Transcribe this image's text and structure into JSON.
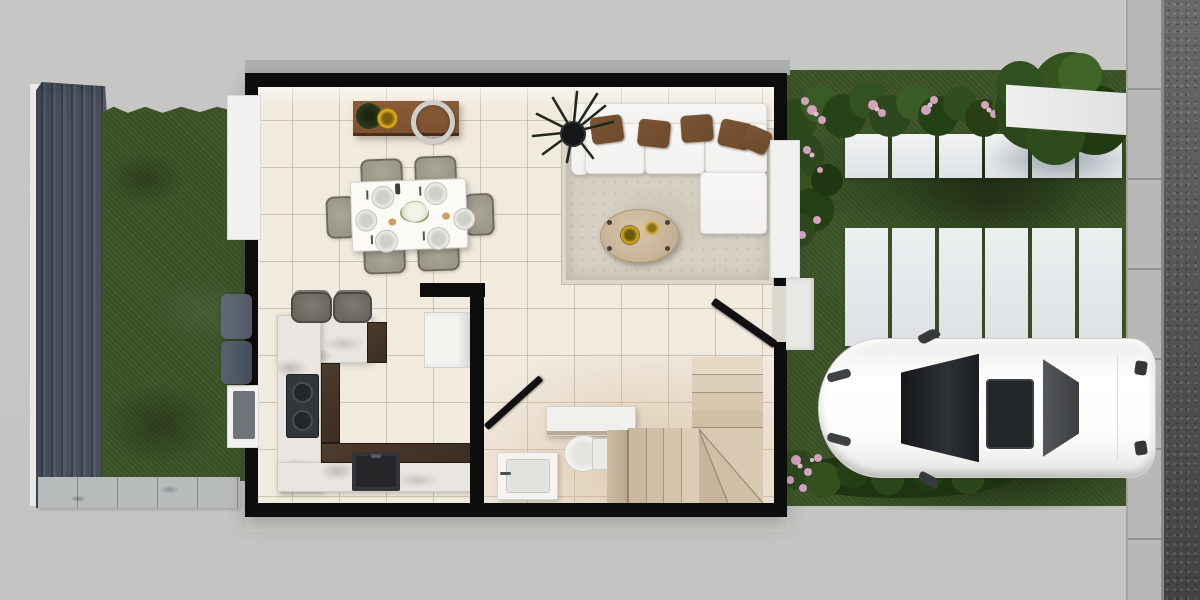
{
  "scene": {
    "render_type": "top-down 3d floor plan render",
    "storeys_visible": 1,
    "rooms": [
      "dining-area",
      "living-area",
      "kitchen",
      "bathroom",
      "stair-hall",
      "entry"
    ],
    "exterior_features": [
      "side-wood-deck",
      "side-lawn",
      "paver-strip",
      "garden-lawn",
      "flower-hedge",
      "garden-tree",
      "stepping-stones",
      "driveway-strips",
      "parked-car",
      "front-walkway",
      "street-curb",
      "asphalt-road"
    ]
  },
  "palette": {
    "ground": "#c6c6c4",
    "ext_band": "#aeaeac",
    "deck": "#49505c",
    "deck_dark": "#394049",
    "grass": "#40582a",
    "paver": "#b8bbbc",
    "wall": "#0d0d0d",
    "floor": "#f1eadf",
    "window": "#f1f2f0",
    "marble": "#e9e6e2",
    "espresso": "#3a2d22",
    "wood": "#7b5130",
    "chair": "#9b9788",
    "sofa": "#f3f2f0",
    "pillow": "#6d4a2c",
    "rug": "#d7d1c5",
    "stair": "#d6c7ae",
    "partition": "#b9a78e",
    "plant": "#2b3a1f",
    "yellow": "#d9a61f",
    "pink": "#d2a2bf",
    "foliage": "#32511f",
    "curb": "#b8b8b6",
    "asphalt": "#585856",
    "car": "#fbfbfa",
    "glass": "#202326",
    "stool": "#6b675f",
    "cooktop": "#34373a",
    "sink": "#242628",
    "ac": "#525a68"
  },
  "house": {
    "dining": {
      "furniture": [
        "sideboard",
        "potted-plant",
        "yellow-bowl",
        "wreath-decor",
        "dining-table",
        "dining-chairs",
        "place-settings"
      ],
      "chair_count": 6,
      "place_setting_count": 6
    },
    "living": {
      "furniture": [
        "area-rug",
        "sectional-sofa",
        "chaise",
        "throw-pillows",
        "oval-coffee-table",
        "decor-bowls",
        "potted-palm"
      ],
      "pillow_count": 5
    },
    "kitchen": {
      "furniture": [
        "u-shaped-marble-counter",
        "espresso-cabinets",
        "cooktop",
        "black-sink",
        "bar-stools",
        "fridge"
      ],
      "stool_count": 2,
      "burner_count": 2
    },
    "bathroom": {
      "furniture": [
        "wall-shelf",
        "toilet",
        "sink-vanity"
      ]
    },
    "staircase": {
      "upper_tread_count": 4,
      "lower_tread_count": 4,
      "winder_corner": true
    },
    "doors": [
      "front-door-open",
      "bathroom-door-open"
    ],
    "windows": [
      "dining-left-window",
      "kitchen-left-window",
      "living-right-window"
    ]
  },
  "garden": {
    "stepping_stones": {
      "square_count": 6,
      "strip_count": 6
    },
    "planting": [
      "flower-hedge-top",
      "garden-tree",
      "flower-bush-left",
      "flower-hedge-bottom"
    ]
  },
  "street": {
    "elements": [
      "concrete-curb",
      "asphalt-road",
      "crossing-pad",
      "front-walkway"
    ]
  },
  "vehicle": {
    "type": "white-sedan",
    "features": [
      "windshield",
      "sunroof",
      "rear-window",
      "side-mirrors",
      "headlights",
      "taillights"
    ]
  },
  "stair_shades": {
    "upper": [
      "#e6dac6",
      "#ddcfb9",
      "#d6c7ae",
      "#cfbfa4"
    ],
    "lower": [
      "#c9b89f",
      "#cfbfa6",
      "#d5c5ad",
      "#dbccb5"
    ]
  }
}
